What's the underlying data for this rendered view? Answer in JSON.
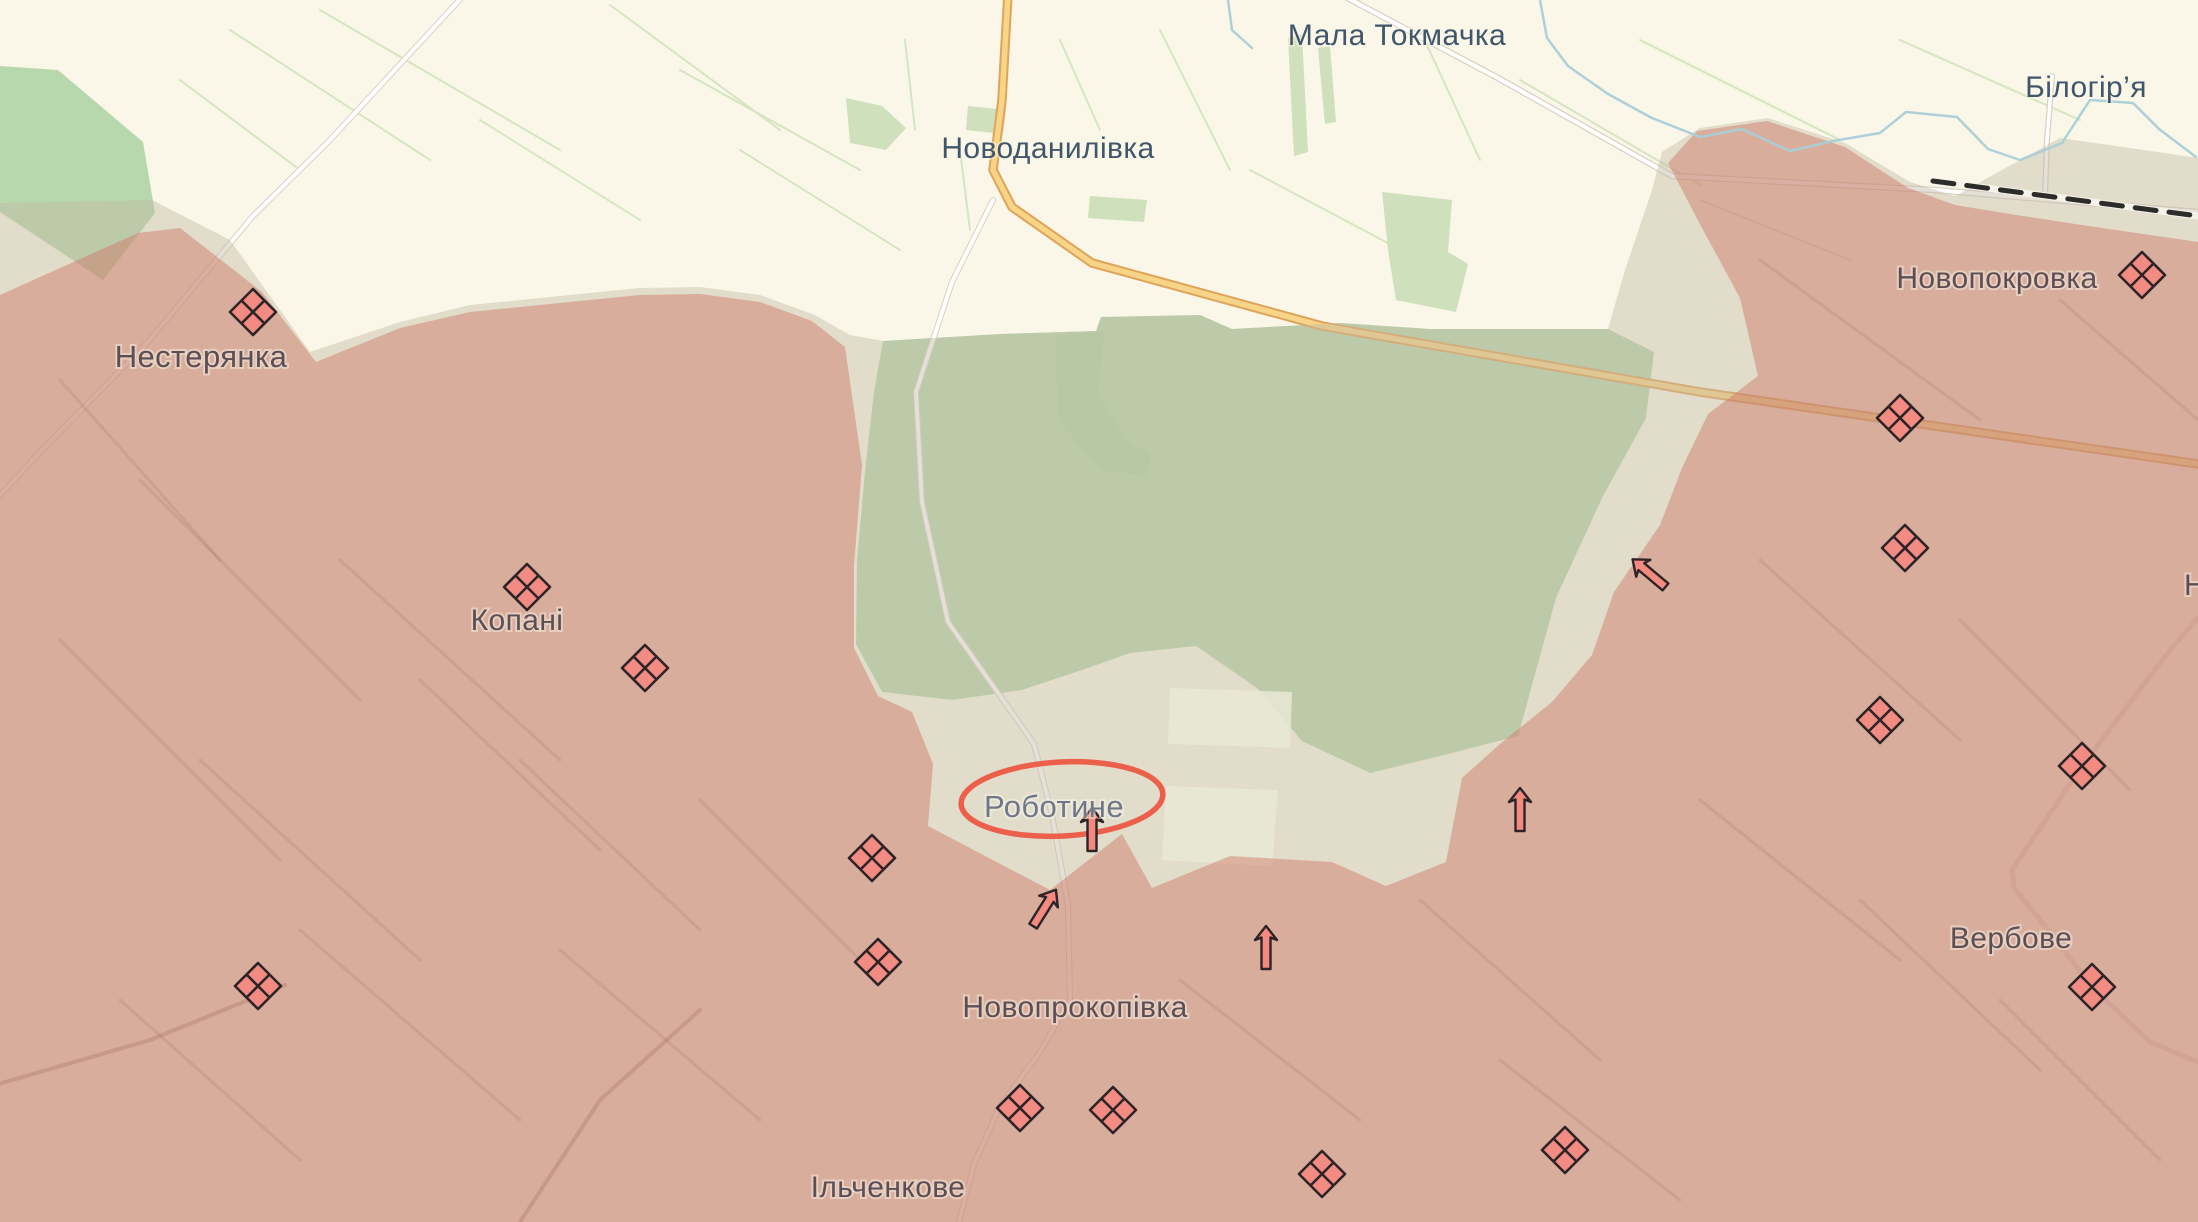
{
  "map": {
    "type": "frontline-war-map",
    "towns": [
      {
        "name": "Мала Токмачка",
        "x": 1397,
        "y": 45,
        "size": 30,
        "color": "#3f566b",
        "anchor": "middle"
      },
      {
        "name": "Білогір’я",
        "x": 2086,
        "y": 97,
        "size": 30,
        "color": "#3f566b",
        "anchor": "middle"
      },
      {
        "name": "Новоданилівка",
        "x": 1048,
        "y": 158,
        "size": 30,
        "color": "#3f566b",
        "anchor": "middle"
      },
      {
        "name": "Нестерянка",
        "x": 201,
        "y": 367,
        "size": 31,
        "color": "#5b4e55",
        "anchor": "middle"
      },
      {
        "name": "Новопокровка",
        "x": 1997,
        "y": 288,
        "size": 30,
        "color": "#5b4e55",
        "anchor": "middle"
      },
      {
        "name": "Копані",
        "x": 517,
        "y": 630,
        "size": 30,
        "color": "#5b4e55",
        "anchor": "middle"
      },
      {
        "name": "Роботине",
        "x": 1054,
        "y": 817,
        "size": 31,
        "color": "#6f7888",
        "anchor": "middle"
      },
      {
        "name": "Новопрокопівка",
        "x": 1075,
        "y": 1017,
        "size": 30,
        "color": "#5b4e55",
        "anchor": "middle"
      },
      {
        "name": "Вербове",
        "x": 2011,
        "y": 948,
        "size": 30,
        "color": "#5b4e55",
        "anchor": "middle"
      },
      {
        "name": "Ільченкове",
        "x": 888,
        "y": 1197,
        "size": 30,
        "color": "#5b4e55",
        "anchor": "middle"
      },
      {
        "name": "Н",
        "x": 2184,
        "y": 595,
        "size": 30,
        "color": "#5b4e55",
        "anchor": "start",
        "clipped_by_edge": true
      }
    ],
    "unit_markers": [
      {
        "x": 253,
        "y": 312
      },
      {
        "x": 527,
        "y": 587
      },
      {
        "x": 645,
        "y": 668
      },
      {
        "x": 872,
        "y": 858
      },
      {
        "x": 878,
        "y": 962
      },
      {
        "x": 258,
        "y": 986
      },
      {
        "x": 1020,
        "y": 1108
      },
      {
        "x": 1113,
        "y": 1110
      },
      {
        "x": 1322,
        "y": 1174
      },
      {
        "x": 1565,
        "y": 1150
      },
      {
        "x": 1900,
        "y": 418
      },
      {
        "x": 1905,
        "y": 548
      },
      {
        "x": 2142,
        "y": 275
      },
      {
        "x": 1880,
        "y": 720
      },
      {
        "x": 2082,
        "y": 766
      },
      {
        "x": 2092,
        "y": 987
      }
    ],
    "attack_arrows": [
      {
        "x": 1092,
        "y": 806,
        "rotation": 0
      },
      {
        "x": 1057,
        "y": 888,
        "rotation": 32
      },
      {
        "x": 1520,
        "y": 786,
        "rotation": 0
      },
      {
        "x": 1266,
        "y": 924,
        "rotation": 0
      },
      {
        "x": 1631,
        "y": 558,
        "rotation": -50
      }
    ],
    "highlight_ellipse": {
      "target": "Роботине",
      "cx": 1062,
      "cy": 799,
      "rx": 101,
      "ry": 37,
      "rotation": -3,
      "color": "#ec5f4a"
    },
    "colors": {
      "background": "#faf7e8",
      "occupied_red": "#d9ae9f",
      "contested_grey": "#e4dcca",
      "forest_green": "#b7d8ad",
      "light_field_green": "#cfe0bd",
      "unit_marker_fill": "#f28b82",
      "marker_outline": "#2d2428",
      "arrow_fill": "#f4897f",
      "road_major_yellow": "#f6d488",
      "road_white": "#ffffff",
      "railway_black": "#2e2c2a",
      "river_blue": "#a9ced8"
    }
  }
}
